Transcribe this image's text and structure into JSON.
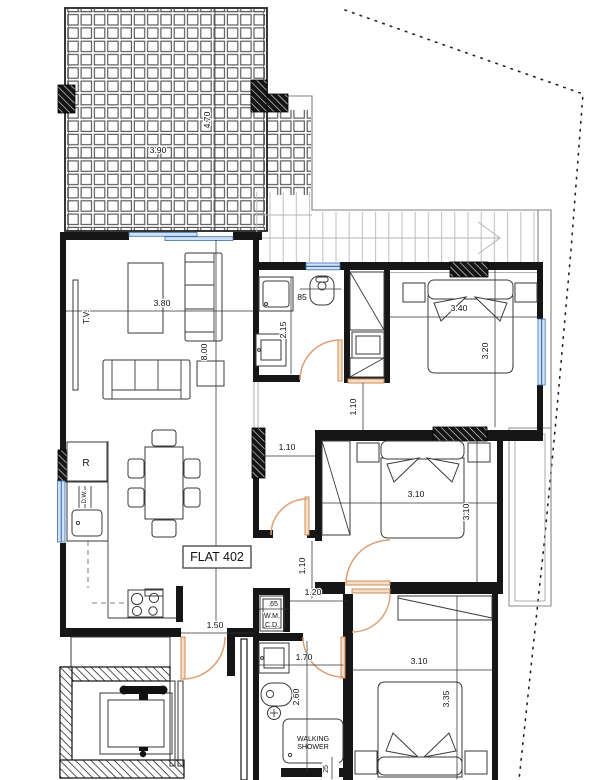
{
  "labels": {
    "flat": "FLAT 402",
    "tv": "T.V.",
    "fridge": "R",
    "dw": "D.W.",
    "wm": "W.M.",
    "cd": "C.D.",
    "shower1": "WALKING",
    "shower2": "SHOWER"
  },
  "dims": {
    "terrace_w": "3.90",
    "terrace_h": "4.70",
    "living_w": "3.80",
    "flat_d": "8.00",
    "wc_niche": "85",
    "bath1_d": "2.15",
    "hall_w": "1.10",
    "bed1_pass": "1.10",
    "bed1_w": "3.40",
    "bed1_d": "3.20",
    "bed2_w": "3.10",
    "bed2_d": "3.10",
    "hall2": "1.10",
    "pass_w": "1.20",
    "entry_w": "1.50",
    "wm_w": ".65",
    "bath2_w": "1.70",
    "bath2_d": "2.60",
    "bed3_w": "3.10",
    "bed3_d": "3.35",
    "shower_edge": "25"
  },
  "colors": {
    "wall": "#161616",
    "door": "#dd9f74",
    "window_fill": "#cfe2f4",
    "window_stroke": "#3f6eae",
    "stair": "#b5b5b5",
    "dim_line": "#333333"
  }
}
